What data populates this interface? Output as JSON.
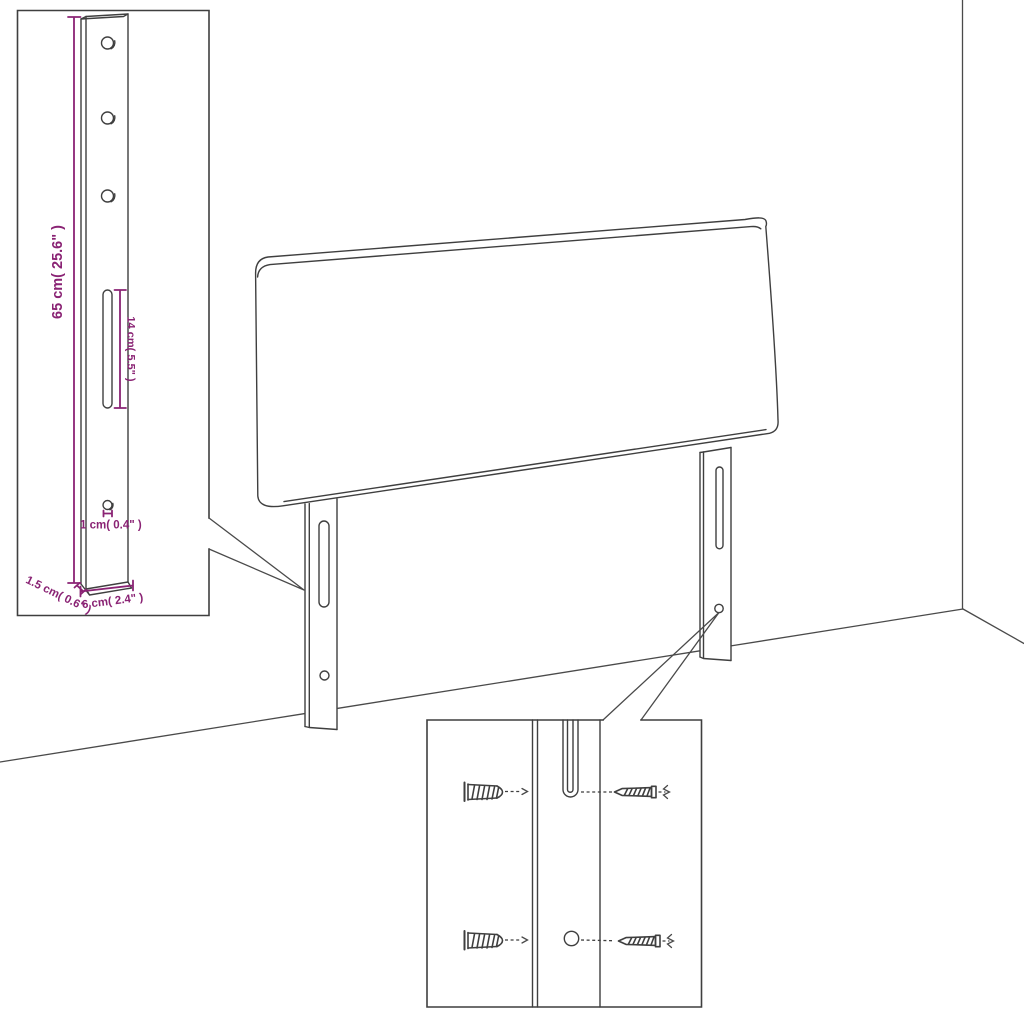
{
  "colors": {
    "line": "#3f3f3f",
    "dimension_accent": "#8a2374",
    "background": "#ffffff"
  },
  "dimension_labels": {
    "bracket_height": "65 cm( 25.6\" )",
    "slot_length": "14 cm( 5.5\" )",
    "hole_diameter": "1 cm( 0.4\" )",
    "bracket_depth": "1.5 cm( 0.6\" )",
    "bracket_width": "6 cm( 2.4\" )"
  }
}
